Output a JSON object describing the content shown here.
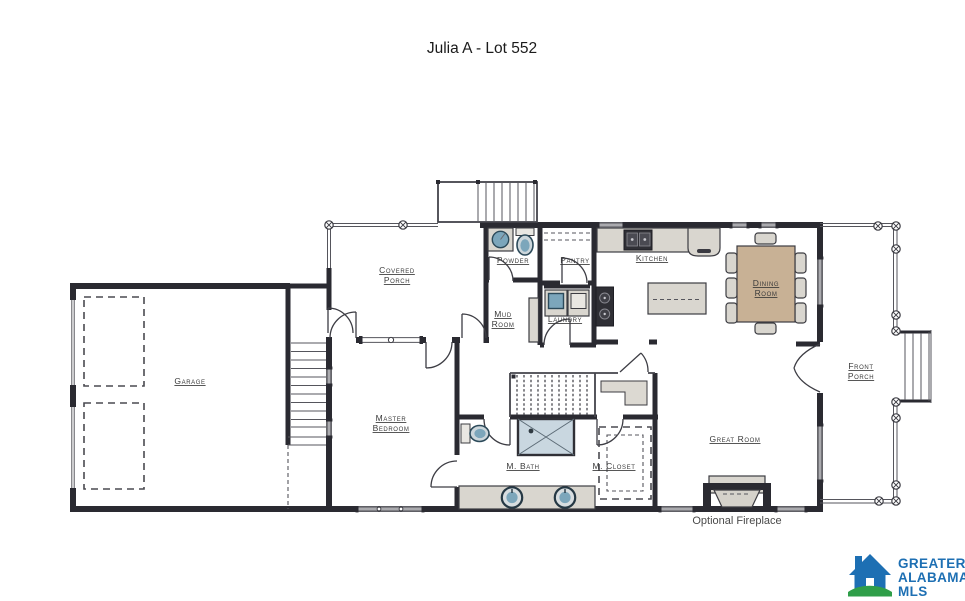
{
  "title": "Julia A - Lot 552",
  "rooms": {
    "garage": "Garage",
    "covered_porch": {
      "line1": "Covered",
      "line2": "Porch"
    },
    "powder": "Powder",
    "mud_room": {
      "line1": "Mud",
      "line2": "Room"
    },
    "pantry": "Pantry",
    "laundry": "Laundry",
    "kitchen": "Kitchen",
    "dining_room": {
      "line1": "Dining",
      "line2": "Room"
    },
    "great_room": "Great Room",
    "master_bedroom": {
      "line1": "Master",
      "line2": "Bedroom"
    },
    "m_bath": "M. Bath",
    "m_closet": "M. Closet",
    "front_porch": {
      "line1": "Front",
      "line2": "Porch"
    }
  },
  "notes": {
    "optional_fireplace": "Optional Fireplace"
  },
  "logo": {
    "line1": "GREATER",
    "line2": "ALABAMA",
    "line3": "MLS"
  },
  "fixtures": [
    "powder-sink",
    "powder-toilet",
    "mud-bench",
    "washer",
    "dryer",
    "wall-ovens",
    "range-cooktop",
    "refrigerator",
    "kitchen-island",
    "pantry-shelves",
    "dining-table",
    "dining-chairs",
    "fireplace",
    "shower",
    "toilet",
    "double-vanity",
    "closet-shelves",
    "garage-doors",
    "stairs",
    "porch-posts"
  ],
  "colors": {
    "wall": "#2a2a31",
    "fixture": "#d9d6cf",
    "appliance_dark": "#2f2f35",
    "plumbing_blue": "#7ca6bb",
    "shower": "#c9d7e0",
    "table_tan": "#c8b195",
    "label": "#3a3a3a",
    "logo_blue": "#1d6fb3",
    "logo_green": "#2f9e49"
  }
}
